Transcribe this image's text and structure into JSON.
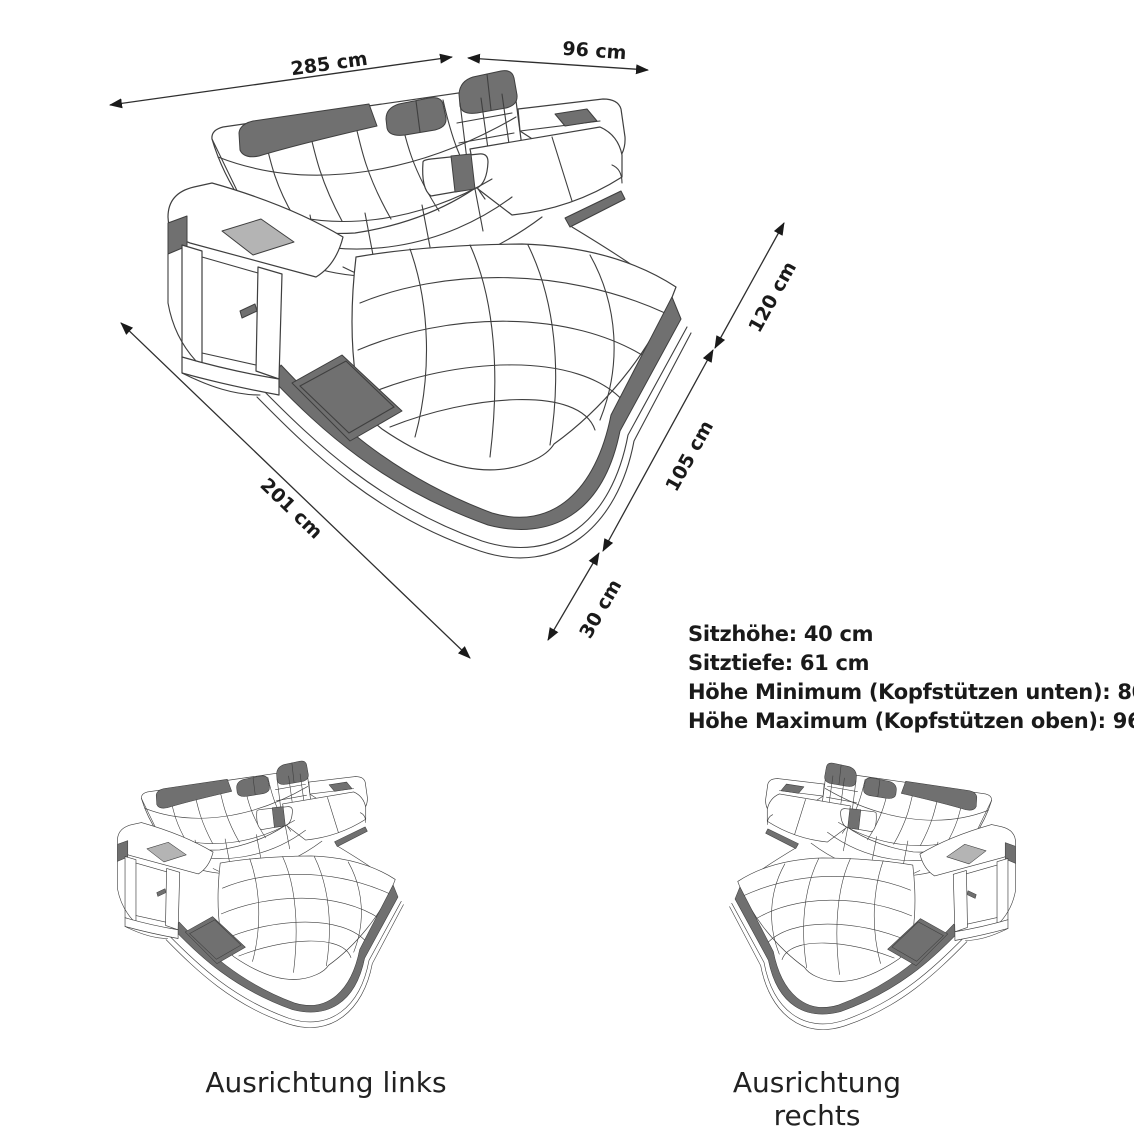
{
  "diagram": {
    "dimension_labels": {
      "back_width": "285 cm",
      "right_depth": "96 cm",
      "side_upper": "120 cm",
      "side_lower": "105 cm",
      "base_height": "30 cm",
      "front_length": "201 cm"
    },
    "spec_lines": [
      "Sitzhöhe: 40 cm",
      "Sitztiefe: 61 cm",
      "Höhe Minimum (Kopfstützen unten): 80 cm",
      "Höhe Maximum (Kopfstützen oben): 96 cm"
    ],
    "variant_labels": [
      "Ausrichtung links",
      "Ausrichtung rechts"
    ],
    "colors": {
      "line": "#3f3f3f",
      "dark_fill": "#707070",
      "light_fill": "#b4b4b4",
      "text": "#1a1a1a",
      "background": "#ffffff"
    }
  }
}
